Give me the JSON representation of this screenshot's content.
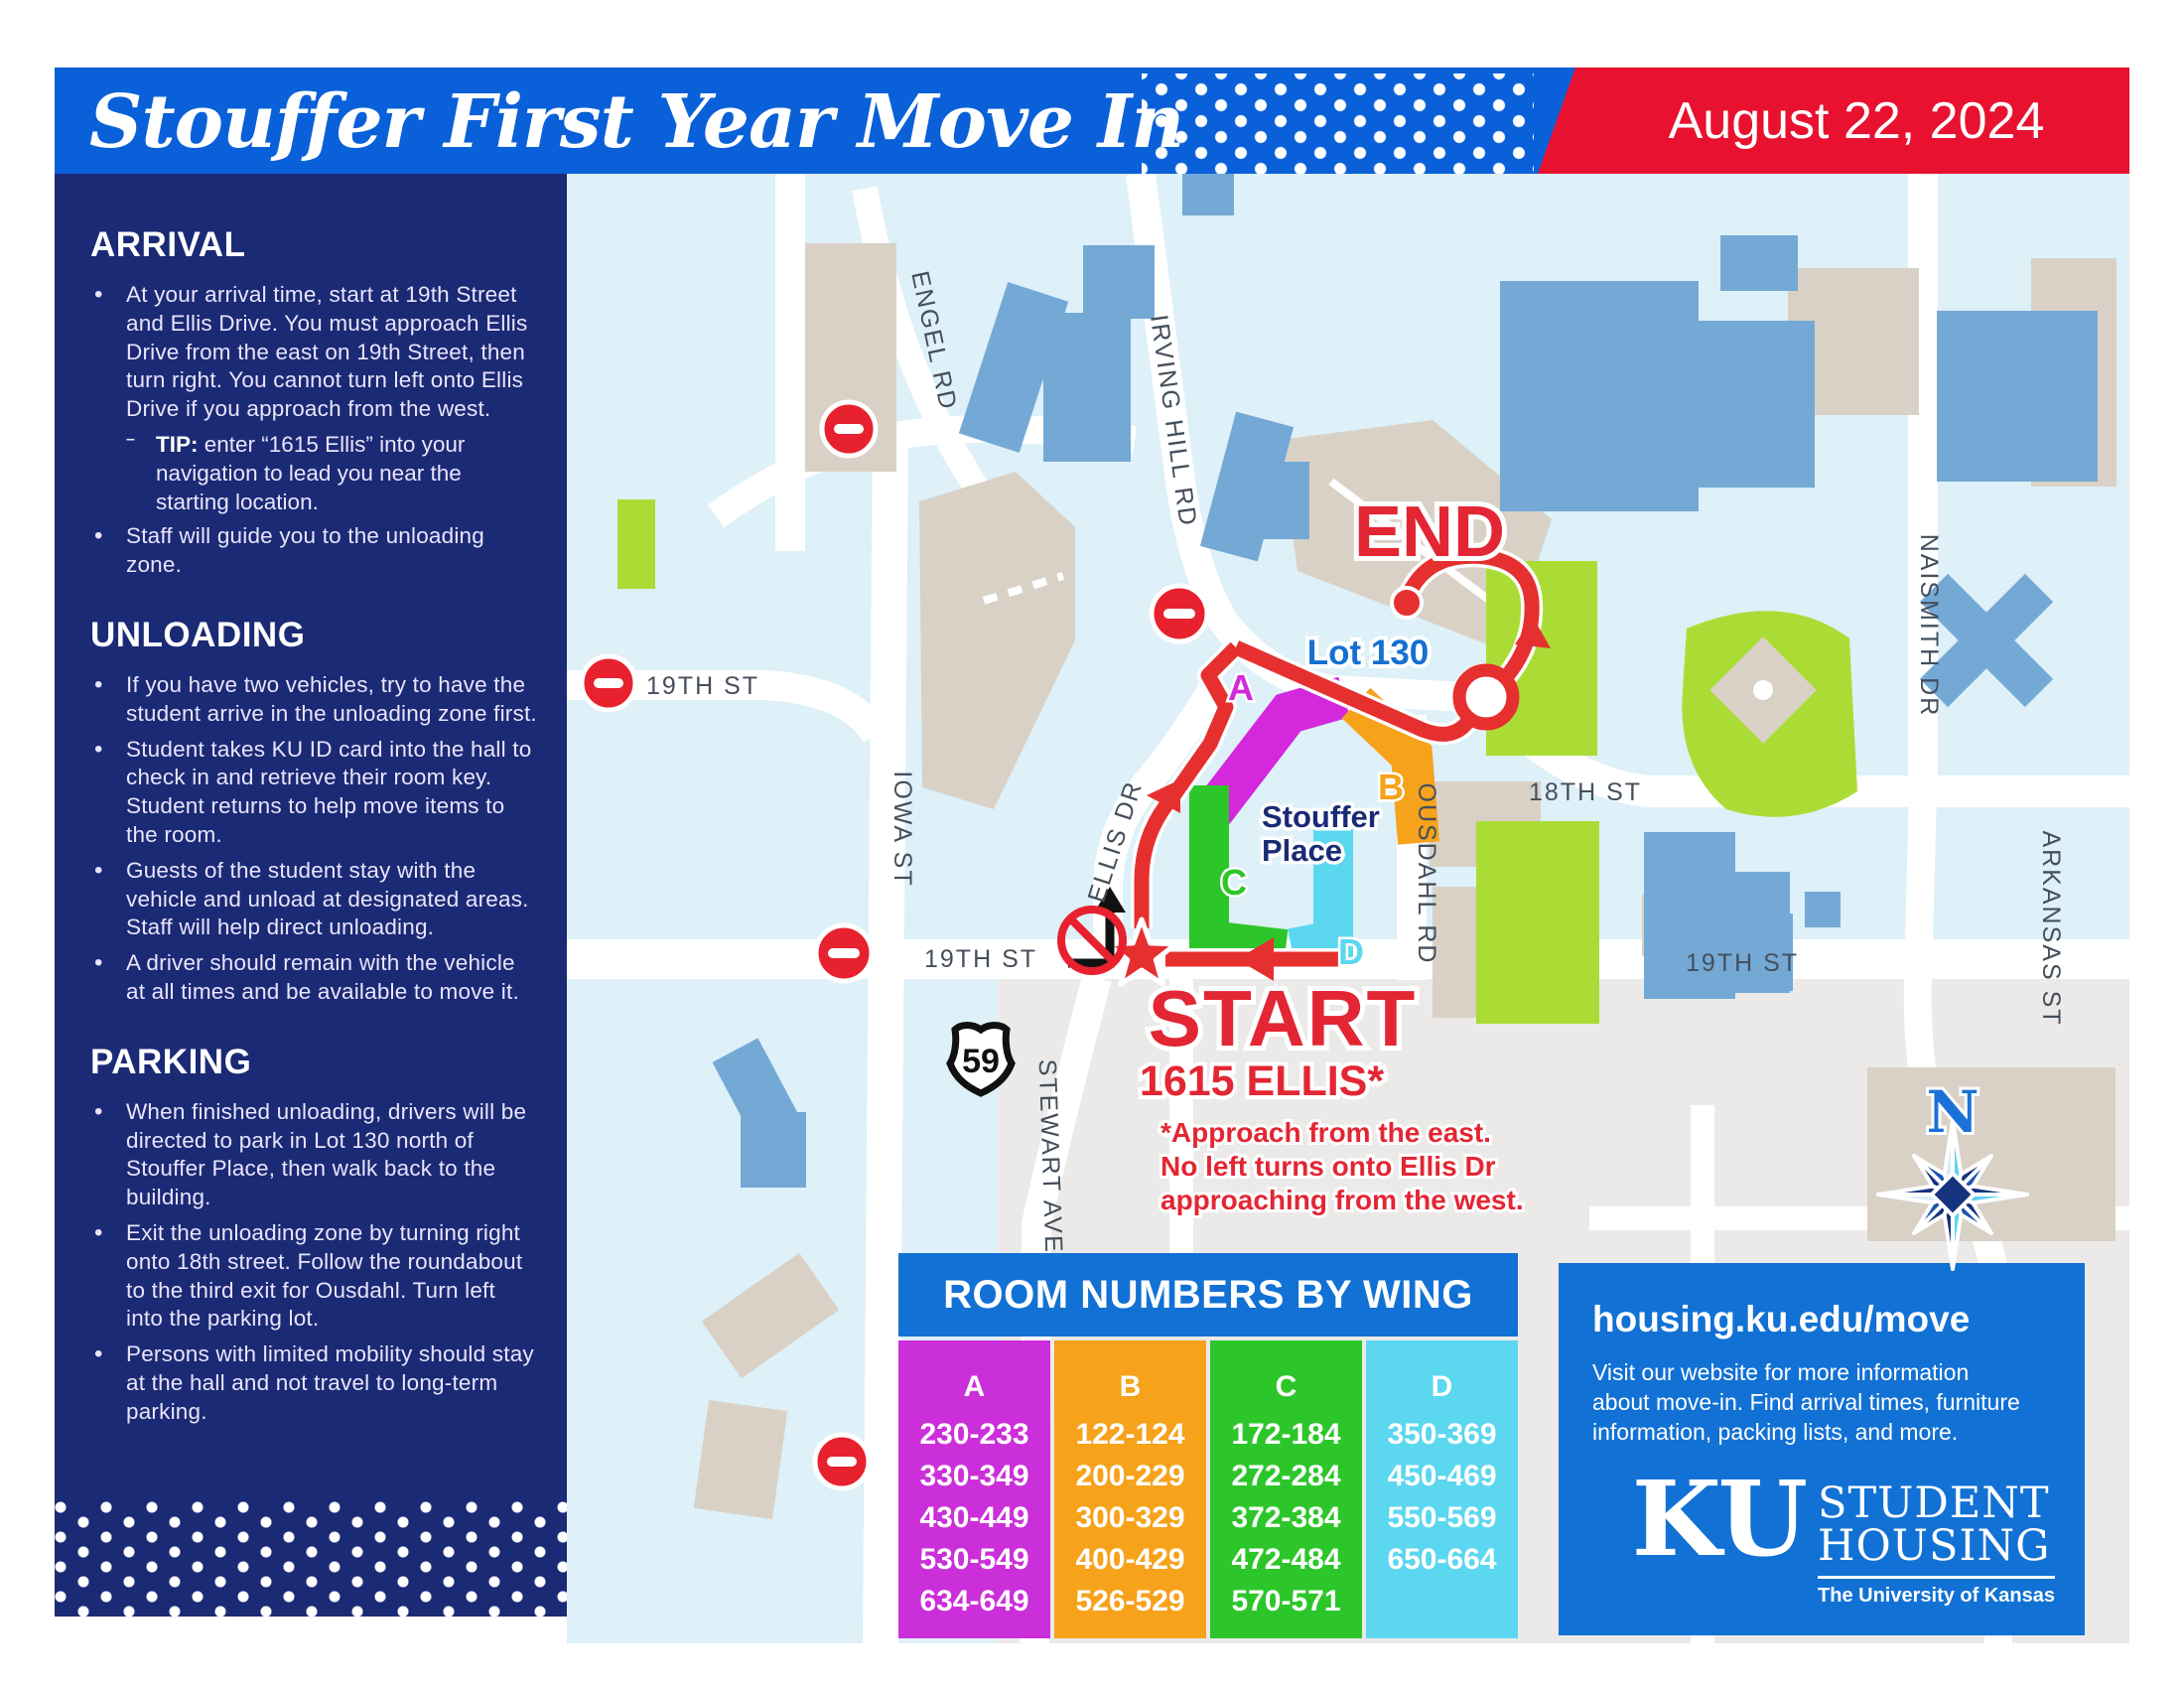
{
  "header": {
    "title": "Stouffer First Year Move In",
    "date": "August 22, 2024"
  },
  "sidebar": {
    "sections": [
      {
        "heading": "ARRIVAL",
        "items": [
          {
            "text": "At your arrival time, start at 19th Street and Ellis Drive. You must approach Ellis Drive from the east on 19th Street, then turn right. You cannot turn left onto Ellis Drive if you approach from the west.",
            "tip_bold": "TIP:",
            "tip_text": "enter “1615 Ellis” into your navigation to lead you near the starting location."
          },
          {
            "text": "Staff will guide you to the unloading zone."
          }
        ]
      },
      {
        "heading": "UNLOADING",
        "items": [
          {
            "text": "If you have two vehicles, try to have the student arrive in the unloading zone first."
          },
          {
            "text": "Student takes KU ID card into the hall to check in and retrieve their room key. Student returns to help move items to the room."
          },
          {
            "text": "Guests of the student stay with the vehicle and unload at designated areas. Staff will help direct unloading."
          },
          {
            "text": "A driver should remain with the vehicle at all times and be available to move it."
          }
        ]
      },
      {
        "heading": "PARKING",
        "items": [
          {
            "text": "When finished unloading, drivers will be directed to park in Lot 130 north of Stouffer Place, then walk back to the building."
          },
          {
            "text": "Exit the unloading zone by turning right onto 18th street. Follow the roundabout to the third exit for Ousdahl. Turn left into the parking lot."
          },
          {
            "text": "Persons with limited mobility should stay at the hall and not travel to long-term parking."
          }
        ]
      }
    ]
  },
  "map": {
    "labels": {
      "engel": "ENGEL RD",
      "irving": "IRVING HILL RD",
      "iowa": "IOWA ST",
      "ellis": "ELLIS DR",
      "ousdahl": "OUSDAHL RD",
      "stewart": "STEWART AVE",
      "naismith": "NAISMITH DR",
      "arkansas": "ARKANSAS ST",
      "st18": "18TH ST",
      "st19_left": "19TH ST",
      "st19_mid": "19TH ST",
      "st19_right": "19TH ST"
    },
    "markers": {
      "end": "END",
      "lot": "Lot 130",
      "place1": "Stouffer",
      "place2": "Place",
      "wing_a": "A",
      "wing_b": "B",
      "wing_c": "C",
      "wing_d": "D",
      "start": "START",
      "start_sub": "1615 ELLIS*",
      "note1": "*Approach from the east.",
      "note2": "No left turns onto Ellis Dr",
      "note3": "approaching from the west.",
      "highway": "59",
      "compass_n": "N"
    },
    "colors": {
      "route_red": "#e63030",
      "map_bg": "#def0f8",
      "building_tan": "#d9d1c6",
      "building_blue": "#74a9d6",
      "grass_lime": "#abdc35"
    }
  },
  "room_table": {
    "title": "ROOM NUMBERS BY WING",
    "wings": [
      {
        "label": "A",
        "color": "#cb2fd9",
        "rooms": [
          "230-233",
          "330-349",
          "430-449",
          "530-549",
          "634-649"
        ]
      },
      {
        "label": "B",
        "color": "#f6a21b",
        "rooms": [
          "122-124",
          "200-229",
          "300-329",
          "400-429",
          "526-529"
        ]
      },
      {
        "label": "C",
        "color": "#2dc62a",
        "rooms": [
          "172-184",
          "272-284",
          "372-384",
          "472-484",
          "570-571"
        ]
      },
      {
        "label": "D",
        "color": "#5bd7f0",
        "rooms": [
          "350-369",
          "450-469",
          "550-569",
          "650-664"
        ]
      }
    ]
  },
  "info_box": {
    "url": "housing.ku.edu/move",
    "text": "Visit our website for more information about move-in. Find arrival times, furniture information, packing lists, and more.",
    "ku": "KU",
    "student": "STUDENT",
    "housing": "HOUSING",
    "univ": "The University of Kansas"
  }
}
